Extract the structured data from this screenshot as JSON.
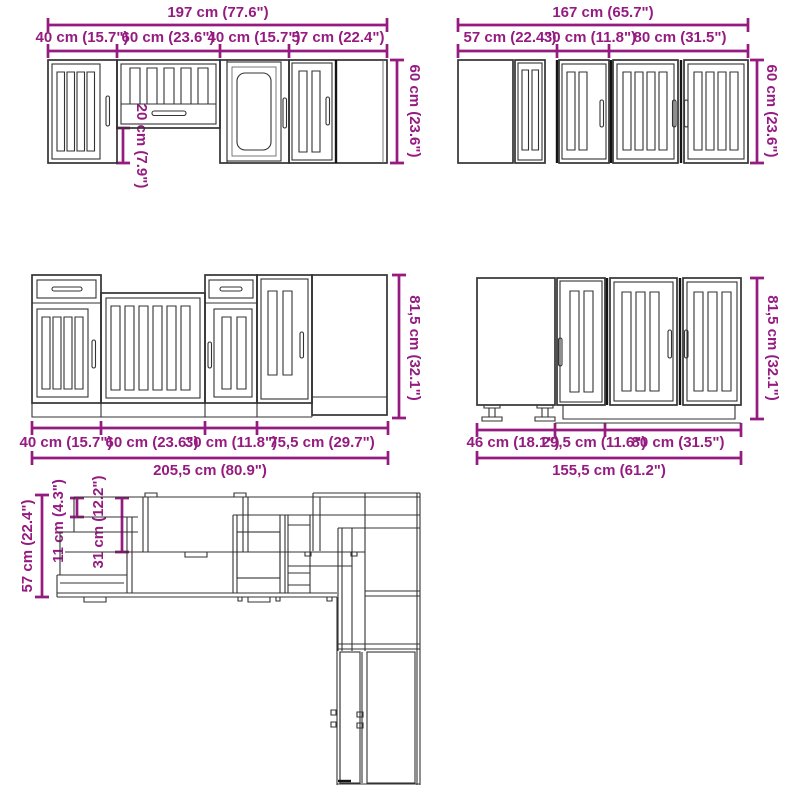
{
  "colors": {
    "background": "#ffffff",
    "dimension": "#951b81",
    "line": "#333333"
  },
  "diagram": {
    "wall_run_left": {
      "total": "197 cm (77.6\")",
      "segments": [
        "40 cm (15.7\")",
        "60 cm (23.6\")",
        "40 cm (15.7\")",
        "57 cm (22.4\")"
      ],
      "height": "60 cm (23.6\")",
      "hood_gap": "20 cm (7.9\")"
    },
    "wall_run_right": {
      "total": "167 cm (65.7\")",
      "segments": [
        "57 cm (22.4\")",
        "30 cm (11.8\")",
        "80 cm (31.5\")"
      ],
      "height": "60 cm (23.6\")"
    },
    "base_run_left": {
      "total": "205,5 cm (80.9\")",
      "segments": [
        "40 cm (15.7\")",
        "60 cm (23.6\")",
        "30 cm (11.8\")",
        "75,5 cm (29.7\")"
      ],
      "height": "81,5 cm (32.1\")"
    },
    "base_run_right": {
      "total": "155,5 cm (61.2\")",
      "segments": [
        "46 cm (18.1\")",
        "29,5 cm (11.6\")",
        "80 cm (31.5\")"
      ],
      "height": "81,5 cm (32.1\")"
    },
    "plan_view": {
      "counter_depth": "57 cm (22.4\")",
      "top_offset": "11 cm (4.3\")",
      "wall_cabinet_depth": "31 cm (12.2\")"
    }
  }
}
